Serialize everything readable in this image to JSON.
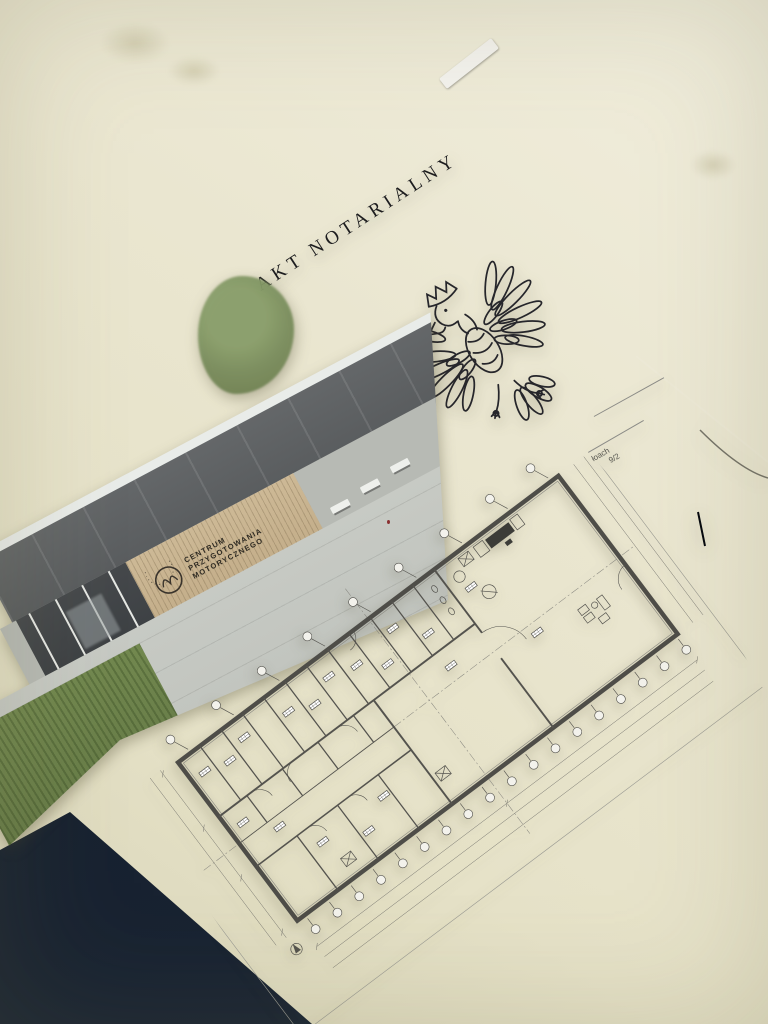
{
  "scene": {
    "desk_color": "#e8e4cb",
    "setting": "papers-on-desk-photo"
  },
  "folder": {
    "color": "#121926",
    "type": "navy-document-folder"
  },
  "notarial_deed": {
    "title": "AKT NOTARIALNY",
    "emblem": "polish-crowned-eagle",
    "paper_color": "#f5f4f0",
    "fragment_line_1": "łoach",
    "fragment_line_2": "9/2"
  },
  "building_photo": {
    "sign_line_1": "CENTRUM",
    "sign_line_2": "PRZYGOTOWANIA",
    "sign_line_3": "MOTORYCZNEGO",
    "logo": "cpm-circle-monogram",
    "sky_color": "#d9dcd4",
    "panel_color": "#5e6163",
    "wood_color": "#c2ac88",
    "glass_color": "#3e4245",
    "pavement_color": "#c3c6c0",
    "grass_color": "#6e8352",
    "tree_color": "#7b8f5e"
  },
  "floor_plan": {
    "paper_color": "#f3f2ec",
    "ink_color": "#54534e",
    "bottom_grid_bubble_count": 18,
    "top_grid_bubble_count": 9
  }
}
